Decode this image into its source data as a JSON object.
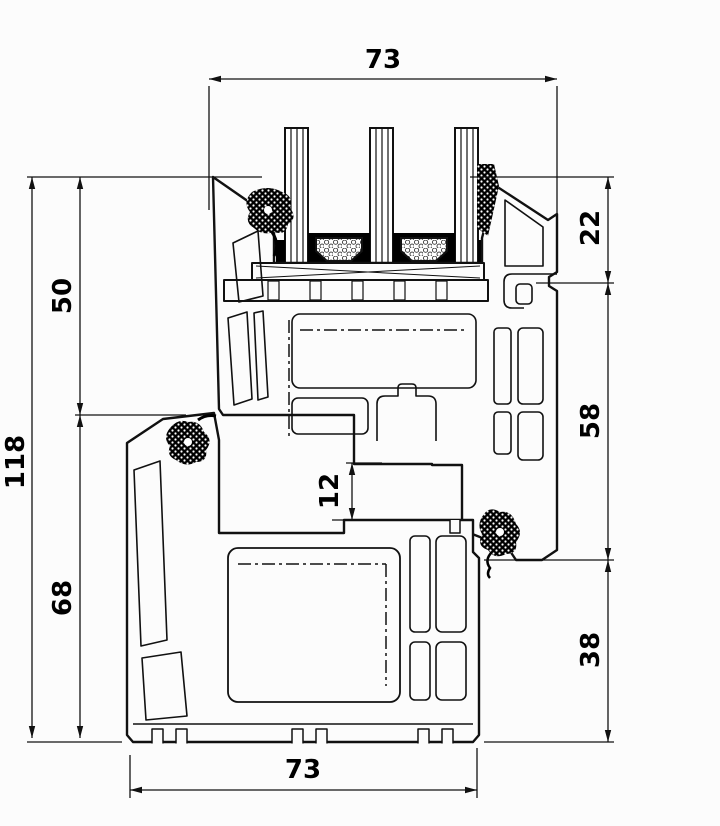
{
  "drawing": {
    "kind": "window-profile-cross-section",
    "subject": "PVC window frame and sash profile section with triple glazing",
    "dimensions": {
      "top_width": "73",
      "right_upper": "22",
      "right_middle": "58",
      "right_lower": "38",
      "left_upper": "50",
      "left_total": "118",
      "left_lower": "68",
      "middle_step": "12",
      "bottom_width": "73"
    },
    "colors": {
      "line": "#111111",
      "background": "#fcfcfc",
      "sealant": "#000000"
    }
  }
}
